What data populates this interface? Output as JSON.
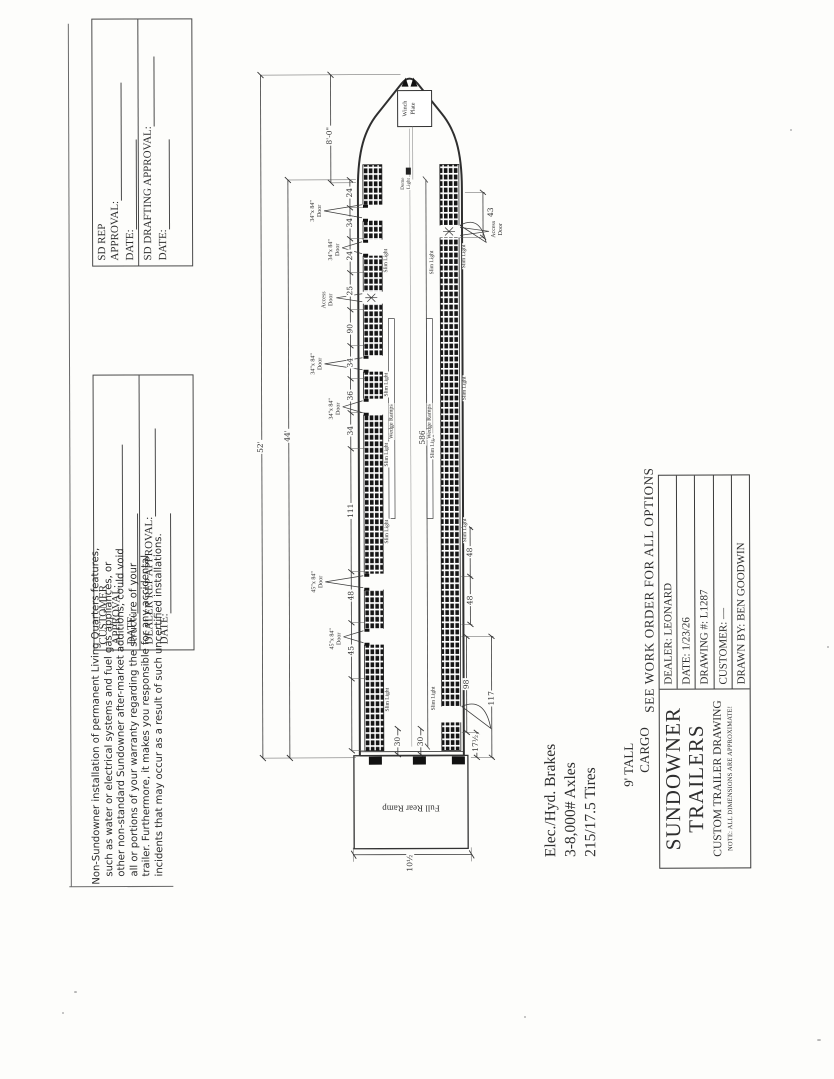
{
  "approval_blocks": {
    "sd_rep": {
      "name": "SD REP",
      "approval": "APPROVAL:",
      "date": "DATE:"
    },
    "sd_drafting": {
      "name": "SD DRAFTING",
      "approval": "APPROVAL:",
      "date": "DATE:"
    },
    "customer": {
      "name": "CUSTOMER",
      "approval": "APPROVAL:",
      "date": "DATE:"
    },
    "dealer_rep": {
      "name": "DEALER REP",
      "approval": "APPROVAL:",
      "date": "DATE:"
    }
  },
  "disclaimer": {
    "lines": [
      "Non-Sundowner installation of permanent Living Quarters features,",
      "such as water or electrical systems and fuel gas appliances, or",
      "other non-standard Sundowner after-market additions, could void",
      "all or portions of your warranty regarding the structure of your",
      "trailer. Furthermore, it makes you responsible for any accidental",
      "incidents that may occur as a result of such uncertified installations."
    ]
  },
  "specs": {
    "lines": [
      "Elec./Hyd. Brakes",
      "3-8,000# Axles",
      "215/17.5 Tires"
    ]
  },
  "size_note": {
    "line1": "9' TALL",
    "line2": "CARGO"
  },
  "title_block": {
    "banner": "SEE WORK ORDER FOR ALL OPTIONS",
    "company_line1": "SUNDOWNER",
    "company_line2": "TRAILERS",
    "drawing_type": "CUSTOM TRAILER DRAWING",
    "note": "NOTE: ALL DIMENSIONS ARE APPROXIMATE!",
    "fields": [
      {
        "label": "DEALER:",
        "value": "LEONARD"
      },
      {
        "label": "DATE:",
        "value": "1/23/26"
      },
      {
        "label": "DRAWING #:",
        "value": "L1287"
      },
      {
        "label": "CUSTOMER:",
        "value": "—"
      },
      {
        "label": "DRAWN BY:",
        "value": "BEN GOODWIN"
      }
    ]
  },
  "drawing": {
    "winch_plate_line1": "Winch",
    "winch_plate_line2": "Plate",
    "full_rear_ramp": "Full Rear Ramp",
    "wedge_ramps": "Wedge Ramps",
    "slim_light": "Slim Light",
    "dome_light_line1": "Dome",
    "dome_light_line2": "Light",
    "door_34": "34\"x 84\"",
    "door_45": "45\"x 84\"",
    "door_word": "Door",
    "access_line1": "Access",
    "access_line2": "Door",
    "dims": {
      "overall": "52'",
      "floor": "44'",
      "gooseneck": "8'-0\"",
      "interior_length": "586",
      "rear_ramp": "10½",
      "top_chain": [
        "24",
        "34",
        "24",
        "25",
        "90",
        "34",
        "36",
        "34",
        "111",
        "48",
        "45"
      ],
      "front_access": "43",
      "lights_48a": "48",
      "lights_48b": "48",
      "rear_98": "98",
      "rear_117": "117",
      "rear_17h": "17½",
      "rear_30a": "30",
      "rear_30b": "30"
    }
  }
}
